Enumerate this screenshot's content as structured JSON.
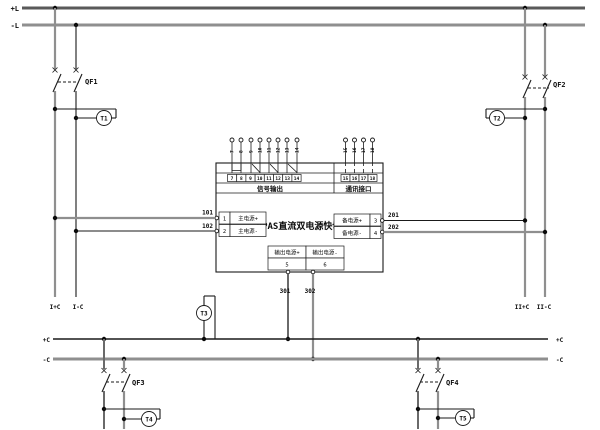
{
  "colors": {
    "line_gray": "#8f8f8f",
    "line_dark": "#1a1a1a",
    "bus_dark": "#5a5a5a",
    "background": "#ffffff"
  },
  "buses": {
    "top_positive": "+L",
    "top_negative": "-L",
    "bottom_positive": "+C",
    "bottom_negative": "-C"
  },
  "feeders": {
    "left_positive": "I+C",
    "left_negative": "I-C",
    "right_positive": "II+C",
    "right_negative": "II-C"
  },
  "breakers": {
    "qf1": "QF1",
    "qf2": "QF2",
    "qf3": "QF3",
    "qf4": "QF4"
  },
  "meters": {
    "t1": "T1",
    "t2": "T2",
    "t3": "T3",
    "t4": "T4",
    "t5": "T5"
  },
  "wire_labels": {
    "w101": "101",
    "w102": "102",
    "w201": "201",
    "w202": "202",
    "w301": "301",
    "w302": "302"
  },
  "device": {
    "title": "DPAS直流双电源快切",
    "main_input": {
      "plus": {
        "no": "1",
        "label": "主电源+"
      },
      "minus": {
        "no": "2",
        "label": "主电源-"
      }
    },
    "backup_input": {
      "plus": {
        "no": "3",
        "label": "备电源+"
      },
      "minus": {
        "no": "4",
        "label": "备电源-"
      }
    },
    "output": {
      "plus": {
        "no": "5",
        "label": "输出电源+"
      },
      "minus": {
        "no": "6",
        "label": "输出电源-"
      }
    },
    "signal_output": {
      "label": "信号输出",
      "terminals": [
        "7",
        "8",
        "9",
        "10",
        "11",
        "12",
        "13",
        "14"
      ]
    },
    "comm_interface": {
      "label": "通讯接口",
      "terminals": [
        "15",
        "16",
        "17",
        "18"
      ]
    }
  }
}
